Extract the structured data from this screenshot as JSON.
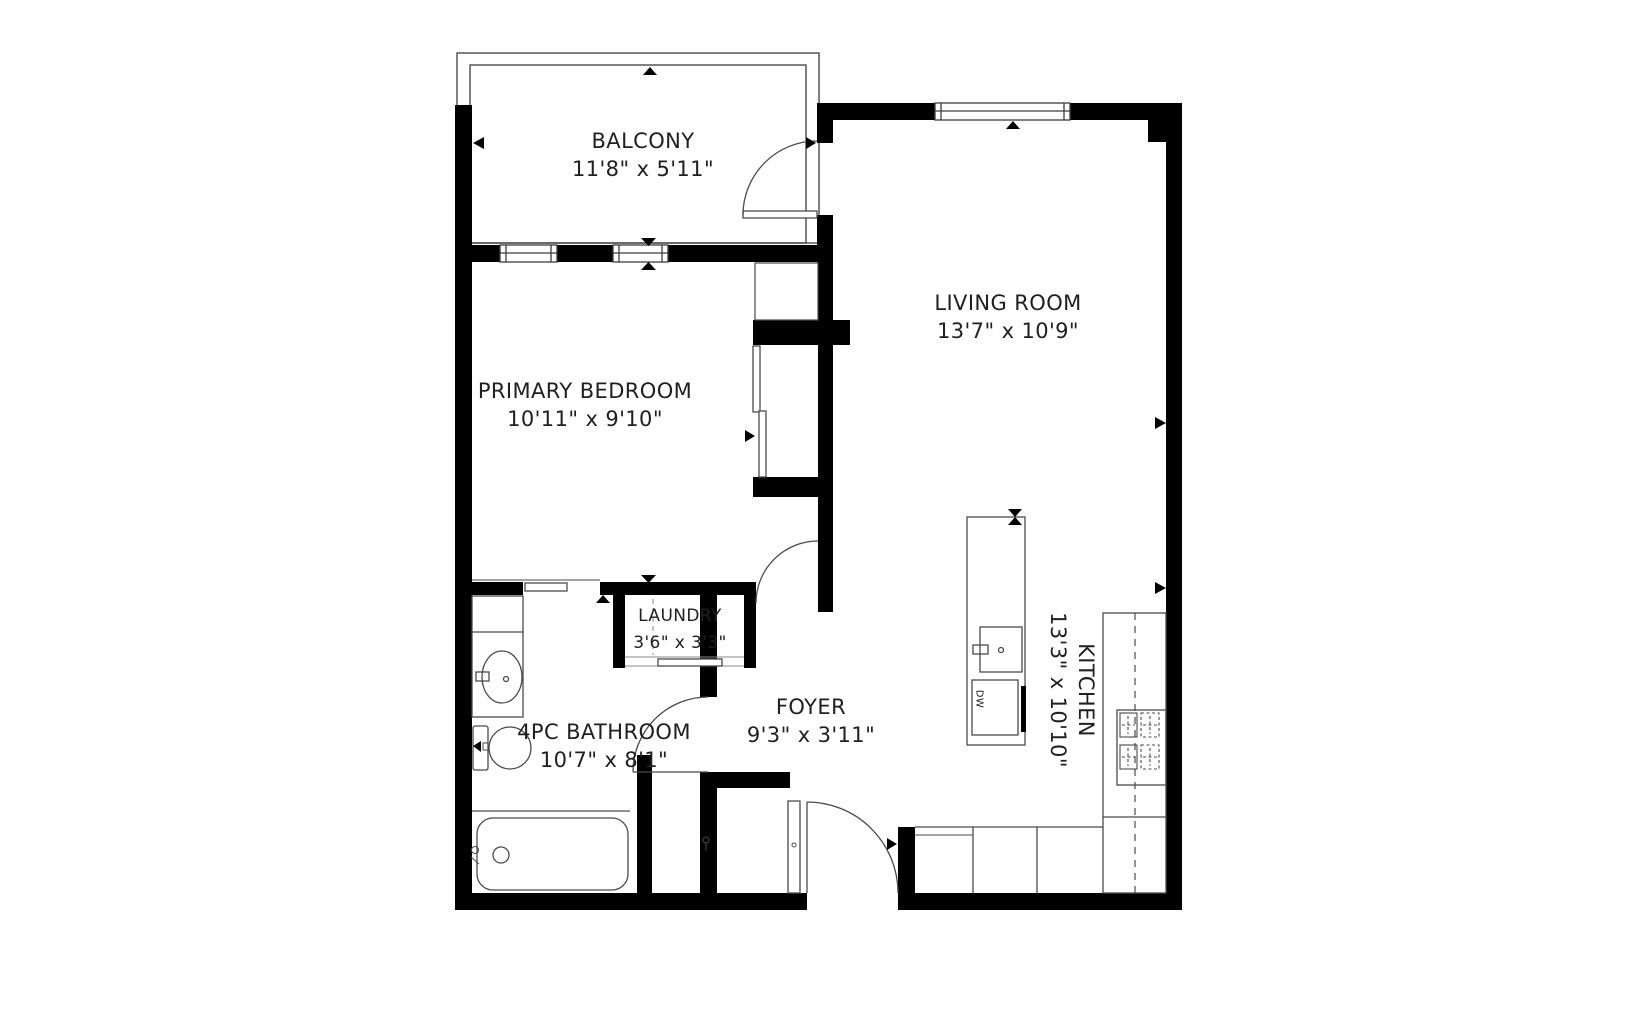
{
  "plan": {
    "title": "apartment-floor-plan",
    "rooms": {
      "balcony": {
        "name": "BALCONY",
        "dims": "11'8\" x 5'11\""
      },
      "living_room": {
        "name": "LIVING ROOM",
        "dims": "13'7\" x 10'9\""
      },
      "primary_bedroom": {
        "name": "PRIMARY BEDROOM",
        "dims": "10'11\" x 9'10\""
      },
      "laundry": {
        "name": "LAUNDRY",
        "dims": "3'6\" x 3'3\""
      },
      "bathroom": {
        "name": "4PC BATHROOM",
        "dims": "10'7\" x 8'1\""
      },
      "foyer": {
        "name": "FOYER",
        "dims": "9'3\" x 3'11\""
      },
      "kitchen": {
        "name": "KITCHEN",
        "dims": "13'3\" x 10'10\""
      }
    },
    "appliances": {
      "dishwasher": "DW"
    },
    "colors": {
      "wall": "#000000",
      "fixture_line": "#4a4a4a",
      "light_line": "#8a8a8a",
      "text": "#202020",
      "background": "#ffffff"
    }
  }
}
